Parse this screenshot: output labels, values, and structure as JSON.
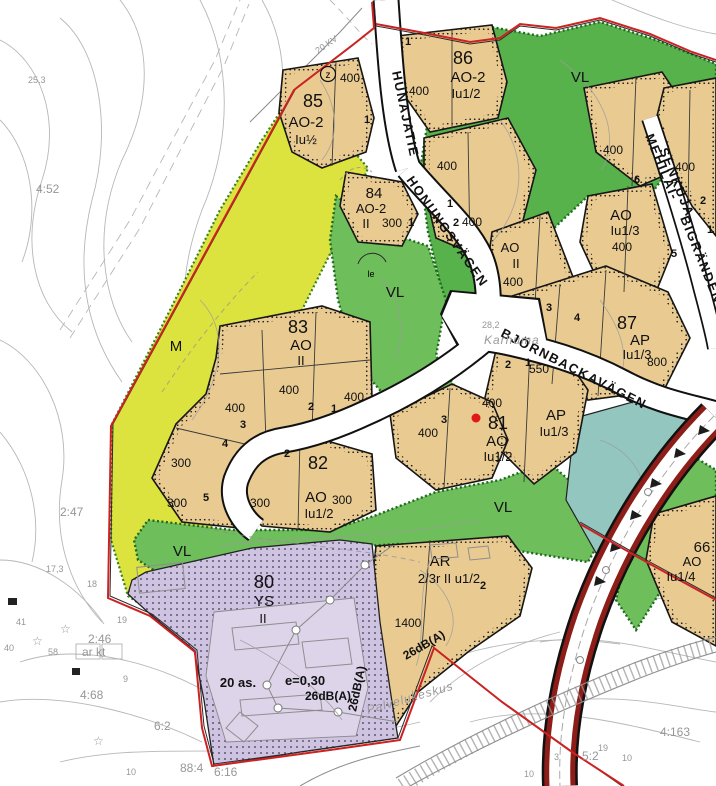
{
  "colors": {
    "residential_tan": "#e9cb92",
    "park_green": "#6fbe5c",
    "agri_yellow": "#dde33e",
    "public_purple": "#cfc3e2",
    "protection_teal": "#93c6bf",
    "boundary_red": "#cd2222",
    "road_red": "#8c1d18",
    "marker_red": "#e01818"
  },
  "streets": {
    "hunajatie": "HUNAJATIE",
    "honungsvagen": "HONUNGSVÄGEN",
    "mehilai": "MEHILÄI-",
    "senkuja": "SENKUJA",
    "bigranden": "BIGRÄNDEN",
    "bjornbackavagen": "BJÖRNBACKAVÄGEN"
  },
  "blocks": {
    "b85": {
      "number": "85",
      "use": "AO-2",
      "eff": "Iu½"
    },
    "b86": {
      "number": "86",
      "use": "AO-2",
      "eff": "Iu1/2"
    },
    "b84": {
      "number": "84",
      "use": "AO-2",
      "storeys": "II"
    },
    "b83": {
      "number": "83",
      "use": "AO",
      "storeys": "II"
    },
    "b82": {
      "number": "82",
      "use": "AO",
      "eff": "Iu1/2"
    },
    "b81": {
      "number": "81",
      "use": "AO",
      "eff": "Iu1/2"
    },
    "b87": {
      "number": "87",
      "use": "AP",
      "eff": "Iu1/3"
    },
    "b80": {
      "number": "80",
      "use": "YS",
      "storeys": "II"
    },
    "b66": {
      "number": "66",
      "use": "AO",
      "eff": "Iu1/4"
    },
    "ap2": {
      "use": "AP",
      "eff": "Iu1/3"
    },
    "aoE": {
      "use": "AO",
      "eff": "Iu1/3"
    },
    "aoMid": {
      "use": "AO",
      "storeys": "II"
    },
    "ar": {
      "use": "AR",
      "eff": "2/3r II u1/2"
    },
    "m": {
      "label": "M"
    },
    "vl": {
      "label": "VL"
    }
  },
  "parcels": [
    {
      "a": "400"
    },
    {
      "a": "400"
    },
    {
      "a": "400"
    },
    {
      "a": "400"
    },
    {
      "a": "300"
    },
    {
      "a": "400"
    },
    {
      "a": "400"
    },
    {
      "a": "400"
    },
    {
      "a": "400"
    },
    {
      "a": "400"
    },
    {
      "a": "400"
    },
    {
      "a": "400"
    },
    {
      "a": "300"
    },
    {
      "a": "300"
    },
    {
      "a": "300"
    },
    {
      "a": "300"
    },
    {
      "a": "400"
    },
    {
      "a": "400"
    },
    {
      "a": "550"
    },
    {
      "a": "1400"
    },
    {
      "a": "800"
    }
  ],
  "lots": [
    {
      "n": "1"
    },
    {
      "n": "1"
    },
    {
      "n": "1"
    },
    {
      "n": "1"
    },
    {
      "n": "2"
    },
    {
      "n": "3"
    },
    {
      "n": "4"
    },
    {
      "n": "6"
    },
    {
      "n": "5"
    },
    {
      "n": "2"
    },
    {
      "n": "1"
    },
    {
      "n": "2"
    },
    {
      "n": "1"
    },
    {
      "n": "3"
    },
    {
      "n": "4"
    },
    {
      "n": "5"
    },
    {
      "n": "2"
    },
    {
      "n": "3"
    },
    {
      "n": "1"
    },
    {
      "n": "2"
    },
    {
      "n": "2"
    }
  ],
  "annotations": {
    "apartments": "20 as.",
    "efficiency": "e=0,30",
    "noise": "26dB(A)",
    "le": "le",
    "transformer": "z"
  },
  "basemap": {
    "cadastral": [
      "4:52",
      "2:47",
      "2:46",
      "4:68",
      "6:2",
      "4:163",
      "5:2",
      "6:16",
      "88:4"
    ],
    "elevations": [
      "25,3",
      "28,2",
      "17,3"
    ],
    "numbers": [
      "41",
      "40",
      "58",
      "19",
      "9",
      "10",
      "18",
      "19",
      "10",
      "3",
      "10"
    ],
    "powerline": "20 KV",
    "names": {
      "karhuma": "Karhuma",
      "palvelukeskus": "Palvelukeskus",
      "arkt": "ar kt"
    }
  }
}
